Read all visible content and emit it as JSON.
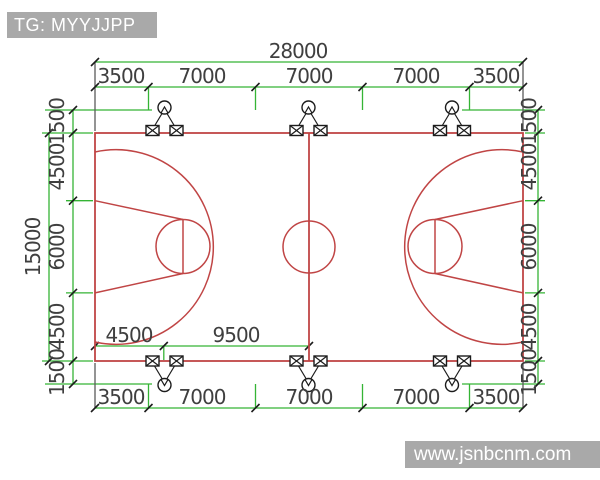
{
  "header_badge": {
    "text": "TG: MYYJJPP"
  },
  "footer_badge": {
    "text": "www.jsnbcnm.com"
  },
  "drawing": {
    "type": "basketball-court-lighting-plan",
    "dims": {
      "top_total": "28000",
      "top_segments": [
        "3500",
        "7000",
        "7000",
        "7000",
        "3500"
      ],
      "bottom_segments": [
        "3500",
        "7000",
        "7000",
        "7000",
        "3500"
      ],
      "left_total": "15000",
      "left_segments": [
        "1500",
        "4500",
        "6000",
        "4500",
        "1500"
      ],
      "right_segments": [
        "1500",
        "4500",
        "6000",
        "4500",
        "1500"
      ],
      "inner_bottom_segments": [
        "4500",
        "9500"
      ]
    },
    "colors": {
      "dimension_line": "#35b435",
      "court_line": "#c04545",
      "extension_line": "#5a5a5a",
      "tick": "#1c1c1c",
      "dim_text": "#3f3f3f",
      "badge_bg": "#a9a9a9",
      "badge_text": "#ffffff"
    }
  }
}
